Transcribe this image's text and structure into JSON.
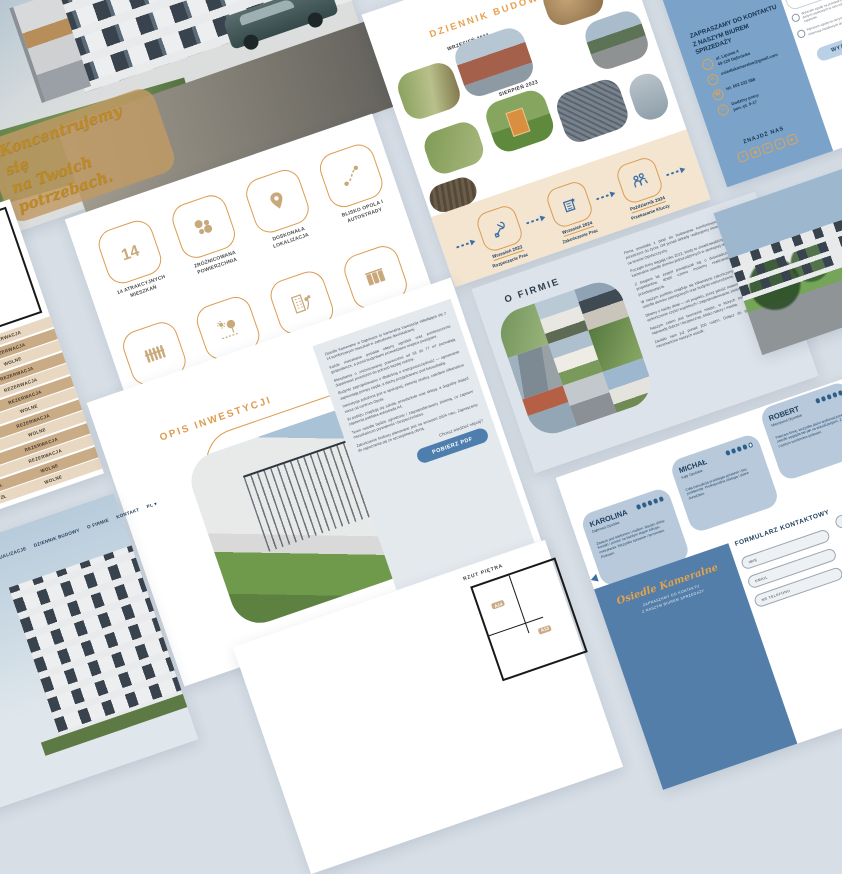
{
  "theme": {
    "background": "#D7DEE6",
    "accent_orange": "#DD9A4F",
    "steel_blue": "#7BA3C9",
    "navy": "#1C3D5C",
    "beige_band": "#F3E5D0",
    "tan_row_light": "#E8D8C2",
    "tan_row_dark": "#C9AB86",
    "dot_blue": "#2E5F8A",
    "button_blue": "#4D7EAE"
  },
  "hero": {
    "logo": "Osiedle Kameralne",
    "tagline_line1": "Koncentrujemy się",
    "tagline_line2": "na Twoich potrzebach."
  },
  "features": {
    "items": [
      {
        "icon": "number-14-icon",
        "label": "14 ATRAKCYJNYCH MIESZKAŃ"
      },
      {
        "icon": "varied-area-icon",
        "label": "ZRÓŻNICOWANA POWIERZCHNIA"
      },
      {
        "icon": "location-pin-icon",
        "label": "DOSKONAŁA LOKALIZACJA"
      },
      {
        "icon": "route-icon",
        "label": "BLISKO OPOLA I AUTOSTRADY"
      },
      {
        "icon": "fence-icon",
        "label": "OGRODZONY TEREN"
      },
      {
        "icon": "nature-icon",
        "label": "PRZYRODA, CISZA I SPOKÓJ"
      },
      {
        "icon": "building-garden-icon",
        "label": "MIESZKANIE Z OGRÓDKIEM"
      },
      {
        "icon": "storage-icon",
        "label": "POMIESZCZENIE GOSPODARCZE"
      }
    ]
  },
  "plan_table": {
    "rooms": [
      "A14",
      "A13"
    ],
    "rows": [
      {
        "price": "352 800 ZŁ",
        "status": "REZERWACJA"
      },
      {
        "price": "348 200 ZŁ",
        "status": "REZERWACJA"
      },
      {
        "price": "356 700 ZŁ",
        "status": "WOLNE"
      },
      {
        "price": "361 400 ZŁ",
        "status": "REZERWACJA"
      },
      {
        "price": "339 900 ZŁ",
        "status": "REZERWACJA"
      },
      {
        "price": "358 300 ZŁ",
        "status": "REZERWACJA"
      },
      {
        "price": "344 700 ZŁ",
        "status": "WOLNE"
      },
      {
        "price": "345 500 ZŁ",
        "status": "REZERWACJA"
      },
      {
        "price": "364 400 ZŁ",
        "status": "WOLNE"
      },
      {
        "price": "378 860 ZŁ",
        "status": "REZERWACJA"
      },
      {
        "price": "365 500 ZŁ",
        "status": "REZERWACJA"
      },
      {
        "price": "378 860 ZŁ",
        "status": "WOLNE"
      },
      {
        "price": "364 900 ZŁ",
        "status": "WOLNE"
      }
    ]
  },
  "diary": {
    "title": "DZIENNIK BUDOWY",
    "date_top": "WRZESIEŃ 2023",
    "date_bottom": "SIERPIEŃ 2023",
    "timeline": [
      {
        "icon": "tools-icon",
        "date": "Wrzesień 2023",
        "label": "Rozpoczęcie Prac"
      },
      {
        "icon": "building-plan-icon",
        "date": "Wrzesień 2024",
        "label": "Zakończenie Prac"
      },
      {
        "icon": "key-handover-icon",
        "date": "Październik 2024",
        "label": "Przekazanie Kluczy"
      }
    ]
  },
  "about": {
    "title": "O FIRMIE",
    "paragraphs": [
      "Firma powstała z pasji do budowania komfortowych i funkcjonalnych przestrzeni do życia. Od ponad dekady realizujemy inwestycje mieszkaniowe na terenie Opolszczyzny.",
      "Początki firmy sięgają roku 2012, kiedy to zrealizowaliśmy pierwszy projekt — kameralne osiedle domów jednorodzinnych w spokojnej okolicy.",
      "Z biegiem lat zespół powiększał się o doświadczonych inżynierów i projektantów, dzięki czemu możemy realizować coraz większe przedsięwzięcia.",
      "W naszym portfolio znajduje się kilkanaście zakończonych inwestycji, w tym osiedla domów szeregowych oraz budynki wielorodzinne.",
      "Dbamy o każdy detal — od projektu, przez jakość materiałów, aż po staranne wykończenie części wspólnych i zagospodarowanie zieleni.",
      "Naszym celem jest tworzenie miejsc, w których mieszkańcy czują się naprawdę dobrze i bezpiecznie, blisko natury i miasta.",
      "Zaufało nam już ponad 200 rodzin. Dołącz do grona zadowolonych mieszkańców naszych osiedli."
    ]
  },
  "contact_card": {
    "heading_line1": "ZAPRASZAMY DO KONTAKTU",
    "heading_line2": "Z NASZYM BIUREM SPRZEDAŻY",
    "items": [
      {
        "icon": "address-icon",
        "glyph": "⌂",
        "line1": "ul. Lipowa 4",
        "line2": "49-120 Dąbrówka"
      },
      {
        "icon": "email-icon",
        "glyph": "✉",
        "line1": "osiedlekameralne@gmail.com",
        "line2": ""
      },
      {
        "icon": "phone-icon",
        "glyph": "☎",
        "line1": "tel. 602 222 588",
        "line2": ""
      },
      {
        "icon": "clock-icon",
        "glyph": "◴",
        "line1": "Godziny pracy",
        "line2": "pon.-pt. 9-17"
      }
    ],
    "find_us": "ZNAJDŹ NAS",
    "socials": [
      {
        "icon": "facebook-icon",
        "glyph": "f"
      },
      {
        "icon": "instagram-icon",
        "glyph": "◉"
      },
      {
        "icon": "linkedin-icon",
        "glyph": "in"
      },
      {
        "icon": "vimeo-icon",
        "glyph": "v"
      },
      {
        "icon": "youtube-icon",
        "glyph": "▶"
      }
    ],
    "consents": [
      "Wyrażam zgodę na przetwarzanie moich danych osobowych w celu odpowiedzi na zapytanie.",
      "Wyrażam zgodę na otrzymywanie informacji handlowych drogą elektroniczną."
    ],
    "send_button": "WYŚLIJ"
  },
  "invest": {
    "title": "OPIS INWESTYCJI",
    "paragraphs": [
      "Osiedle Kameralne w Dąbrówce to kameralna inwestycja składająca się z 14 komfortowych mieszkań w zabudowie dwulokalowej.",
      "Każde mieszkanie posiada własny ogródek oraz pomieszczenie gospodarcze, a przed budynkami przewidziano miejsca postojowe.",
      "Mieszkania o zróżnicowanej powierzchni od 53 do 77 m² pozwalają dopasować przestrzeń do potrzeb każdej rodziny.",
      "Budynki zaprojektowano z dbałością o energooszczędność — ogrzewanie zapewniają pompy ciepła, a dachy przygotowano pod fotowoltaikę.",
      "Inwestycja położona jest w spokojnej, zielonej okolicy, zaledwie kilkanaście minut od centrum Opola.",
      "W pobliżu znajdują się szkoła, przedszkole oraz sklepy, a dogodny dojazd zapewnia pobliska autostrada A4.",
      "Teren osiedla będzie ogrodzony i zagospodarowany zielenią, co zapewni mieszkańcom prywatność i bezpieczeństwo.",
      "Zakończenie budowy planowane jest na wrzesień 2024 roku. Zapraszamy do zapoznania się ze szczegółową ofertą."
    ],
    "more_label": "Chcesz wiedzieć więcej?",
    "pdf_button": "POBIERZ PDF"
  },
  "testimonials": {
    "members": [
      {
        "name": "KAROLINA",
        "location": "Dąbrowa Opolska",
        "rating": 5,
        "text": "Zawsze pod telefonem i mailem. Bardzo dobry kontakt i pomoc na każdym etapie zakupu mieszkania. Wszystko sprawnie i terminowo. Polecam."
      },
      {
        "name": "MICHAŁ",
        "location": "Kąty Opolskie",
        "rating": 4,
        "text": "Cała transakcja przebiegła sprawnie i bez problemów. Profesjonalna obsługa i dobre doradztwo."
      },
      {
        "name": "ROBERT",
        "location": "Mierzęcice Opolskie",
        "rating": 5,
        "text": "Polecam firmę, wszystko jasno wytłumaczone, a osiedle wygląda tak jak na wizualizacjach. Z czystym sumieniem polecam."
      }
    ]
  },
  "contact_form": {
    "brand": "Osiedle Kameralne",
    "brand_sub1": "ZAPRASZAMY DO KONTAKTU",
    "brand_sub2": "Z NASZYM BIUREM SPRZEDAŻY",
    "heading": "FORMULARZ KONTAKTOWY",
    "fields": {
      "first_name": "IMIĘ",
      "email": "EMAIL",
      "phone": "NR TELEFONU",
      "last_name": "NAZWISKO",
      "message": "WIADOMOŚĆ"
    },
    "consent": "Wyrażam zgodę na przetwarzanie moich danych osobowych zawartych w formularzu w celu udzielenia odpowiedzi na przesłane zapytanie, zgodnie z polityką prywatności."
  },
  "website": {
    "nav": [
      "LOKALE",
      "WIZUALIZACJE",
      "DZIENNIK BUDOWY",
      "O FIRMIE",
      "KONTAKT"
    ],
    "lang": "PL ▾",
    "logo": "Osiedle Kameralne"
  },
  "floor_plan_slide": {
    "label": "RZUT PIĘTRA",
    "rooms": [
      "A14",
      "A13"
    ]
  }
}
